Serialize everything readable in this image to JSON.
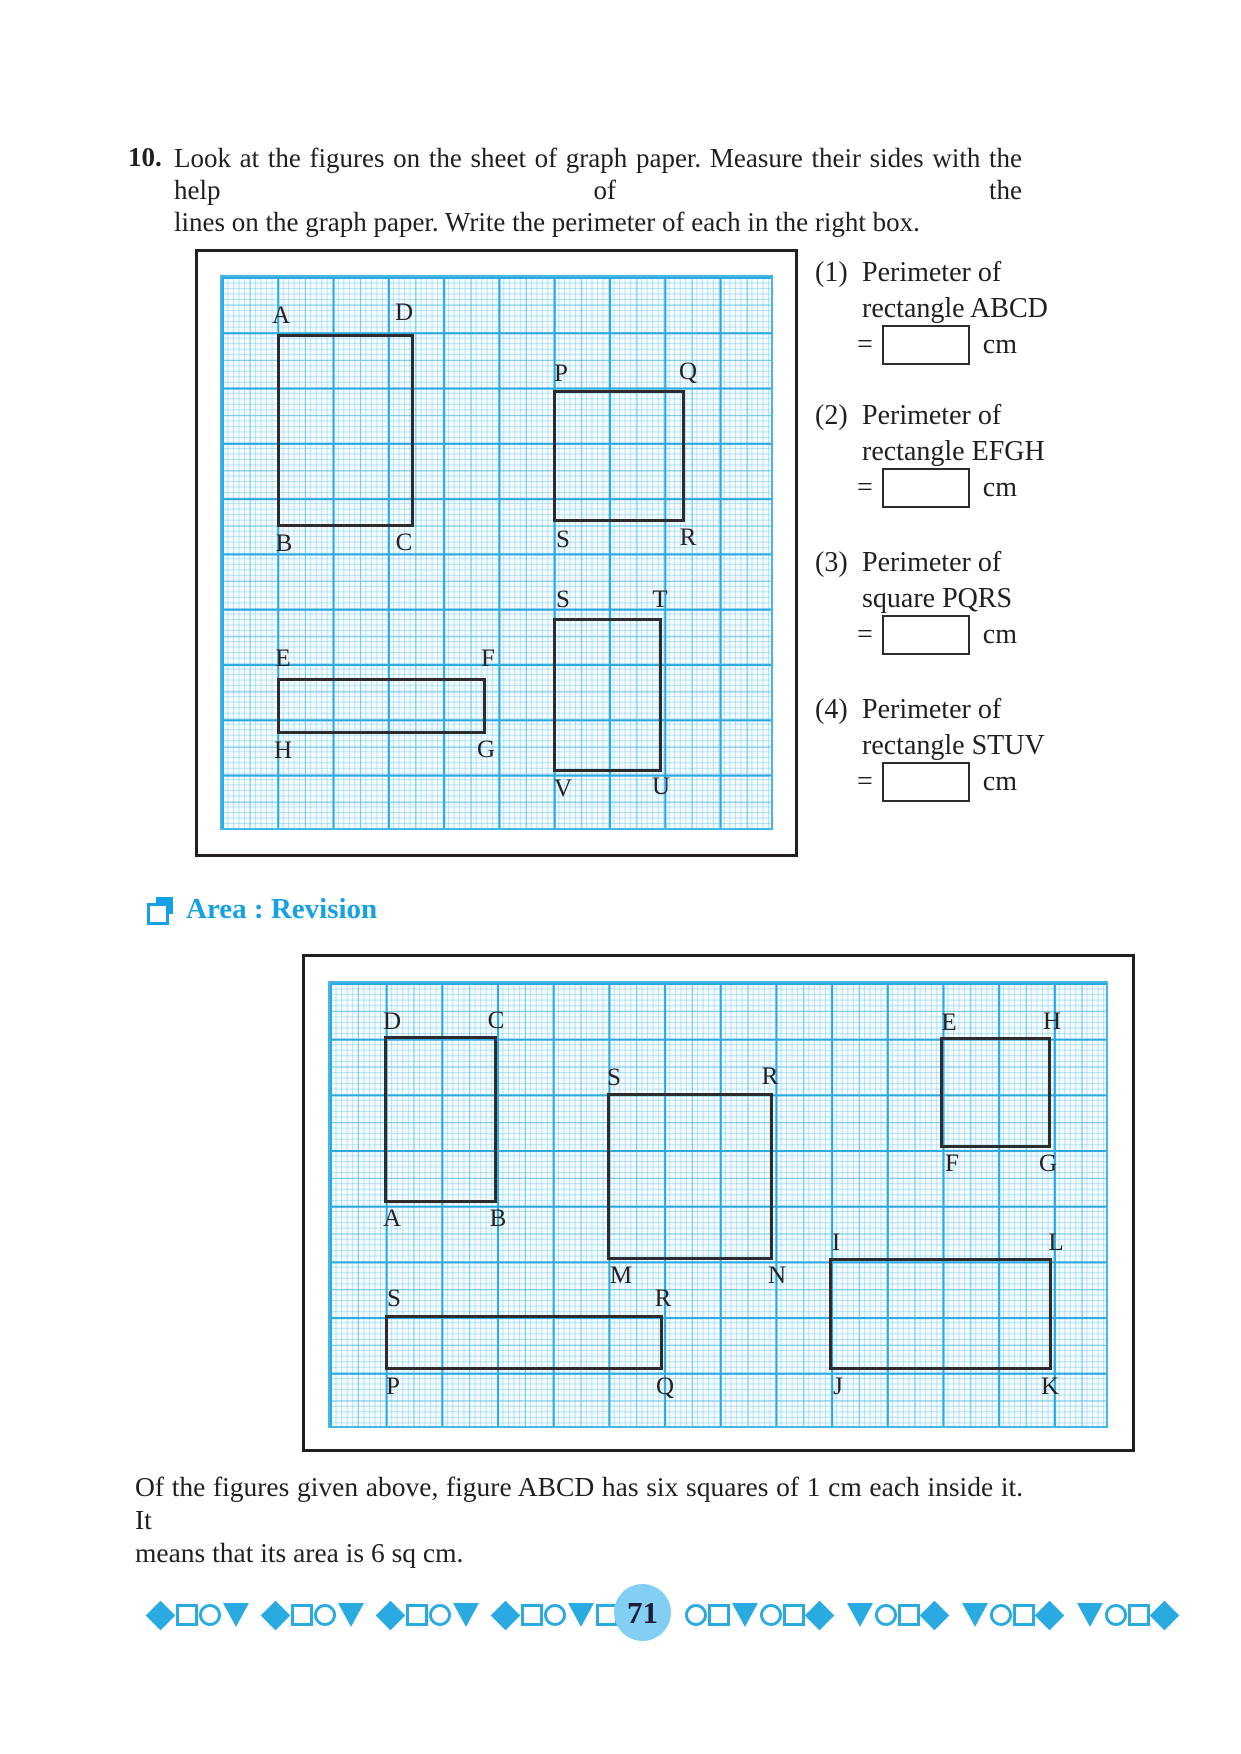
{
  "question": {
    "number": "10.",
    "line1": "Look at the figures on the sheet of graph paper. Measure their sides with the help of the",
    "line2": "lines on the graph paper. Write the perimeter of each in the right box."
  },
  "perimeter_items": [
    {
      "num": "(1)",
      "line1": "Perimeter of",
      "line2": "rectangle ABCD",
      "equals": "=",
      "value": "",
      "unit": "cm"
    },
    {
      "num": "(2)",
      "line1": "Perimeter of",
      "line2": "rectangle EFGH",
      "equals": "=",
      "value": "",
      "unit": "cm"
    },
    {
      "num": "(3)",
      "line1": "Perimeter of",
      "line2": "square PQRS",
      "equals": "=",
      "value": "",
      "unit": "cm"
    },
    {
      "num": "(4)",
      "line1": "Perimeter of",
      "line2": "rectangle STUV",
      "equals": "=",
      "value": "",
      "unit": "cm"
    }
  ],
  "section_heading": "Area : Revision",
  "paragraph": {
    "line1": "Of the figures given above, figure ABCD has six squares of 1 cm each inside it. It",
    "line2": "means that its area is 6 sq cm."
  },
  "page_number": "71",
  "colors": {
    "accent_cyan": "#29ABE2",
    "heading_blue": "#17A0E3",
    "page_circle_fill": "#82CFF3",
    "ink": "#231F20"
  },
  "graphs": [
    {
      "name": "perimeter-graph",
      "box": [
        195,
        249,
        603,
        608
      ],
      "grid": [
        220,
        275,
        553,
        555
      ],
      "grid_class": "g1",
      "figures": [
        {
          "id": "ABCD",
          "rect": [
            277,
            334,
            137,
            193
          ],
          "labels": [
            {
              "t": "A",
              "x": 281,
              "y": 303
            },
            {
              "t": "D",
              "x": 404,
              "y": 300
            },
            {
              "t": "B",
              "x": 284,
              "y": 531
            },
            {
              "t": "C",
              "x": 404,
              "y": 530
            }
          ]
        },
        {
          "id": "PQRS",
          "rect": [
            553,
            390,
            132,
            132
          ],
          "labels": [
            {
              "t": "P",
              "x": 561,
              "y": 361
            },
            {
              "t": "Q",
              "x": 688,
              "y": 359
            },
            {
              "t": "S",
              "x": 563,
              "y": 527
            },
            {
              "t": "R",
              "x": 688,
              "y": 525
            }
          ]
        },
        {
          "id": "EFGH",
          "rect": [
            277,
            678,
            209,
            56
          ],
          "labels": [
            {
              "t": "E",
              "x": 283,
              "y": 646
            },
            {
              "t": "F",
              "x": 488,
              "y": 646
            },
            {
              "t": "H",
              "x": 283,
              "y": 738
            },
            {
              "t": "G",
              "x": 486,
              "y": 737
            }
          ]
        },
        {
          "id": "STUV",
          "rect": [
            553,
            618,
            109,
            154
          ],
          "labels": [
            {
              "t": "S",
              "x": 563,
              "y": 587
            },
            {
              "t": "T",
              "x": 660,
              "y": 587
            },
            {
              "t": "V",
              "x": 563,
              "y": 776
            },
            {
              "t": "U",
              "x": 661,
              "y": 774
            }
          ]
        }
      ]
    },
    {
      "name": "area-graph",
      "box": [
        302,
        954,
        833,
        498
      ],
      "grid": [
        328,
        981,
        780,
        447
      ],
      "grid_class": "g2",
      "figures": [
        {
          "id": "DCAB",
          "rect": [
            384,
            1036,
            113,
            167
          ],
          "labels": [
            {
              "t": "D",
              "x": 392,
              "y": 1009
            },
            {
              "t": "C",
              "x": 496,
              "y": 1008
            },
            {
              "t": "A",
              "x": 392,
              "y": 1206
            },
            {
              "t": "B",
              "x": 498,
              "y": 1206
            }
          ]
        },
        {
          "id": "SRMN",
          "rect": [
            607,
            1093,
            166,
            167
          ],
          "labels": [
            {
              "t": "S",
              "x": 614,
              "y": 1065
            },
            {
              "t": "R",
              "x": 770,
              "y": 1064
            },
            {
              "t": "M",
              "x": 621,
              "y": 1263
            },
            {
              "t": "N",
              "x": 777,
              "y": 1263
            }
          ]
        },
        {
          "id": "EHFG",
          "rect": [
            940,
            1037,
            111,
            111
          ],
          "labels": [
            {
              "t": "E",
              "x": 949,
              "y": 1010
            },
            {
              "t": "H",
              "x": 1052,
              "y": 1009
            },
            {
              "t": "F",
              "x": 952,
              "y": 1151
            },
            {
              "t": "G",
              "x": 1048,
              "y": 1151
            }
          ]
        },
        {
          "id": "ILJK",
          "rect": [
            829,
            1258,
            223,
            112
          ],
          "labels": [
            {
              "t": "I",
              "x": 836,
              "y": 1230
            },
            {
              "t": "L",
              "x": 1056,
              "y": 1230
            },
            {
              "t": "J",
              "x": 838,
              "y": 1374
            },
            {
              "t": "K",
              "x": 1050,
              "y": 1374
            }
          ]
        },
        {
          "id": "SPQR",
          "rect": [
            385,
            1315,
            278,
            55
          ],
          "labels": [
            {
              "t": "S",
              "x": 394,
              "y": 1286
            },
            {
              "t": "R",
              "x": 663,
              "y": 1286
            },
            {
              "t": "P",
              "x": 393,
              "y": 1374
            },
            {
              "t": "Q",
              "x": 665,
              "y": 1374
            }
          ]
        }
      ]
    }
  ],
  "footer": {
    "left_groups": [
      [
        "diamond",
        "square",
        "circle",
        "triangle"
      ],
      [
        "diamond",
        "square",
        "circle",
        "triangle"
      ],
      [
        "diamond",
        "square",
        "circle",
        "triangle"
      ],
      [
        "diamond",
        "square",
        "circle",
        "triangle",
        "square",
        "circle"
      ]
    ],
    "right_groups": [
      [
        "circle",
        "square",
        "triangle",
        "circle",
        "square",
        "diamond"
      ],
      [
        "triangle",
        "circle",
        "square",
        "diamond"
      ],
      [
        "triangle",
        "circle",
        "square",
        "diamond"
      ],
      [
        "triangle",
        "circle",
        "square",
        "diamond"
      ]
    ]
  }
}
